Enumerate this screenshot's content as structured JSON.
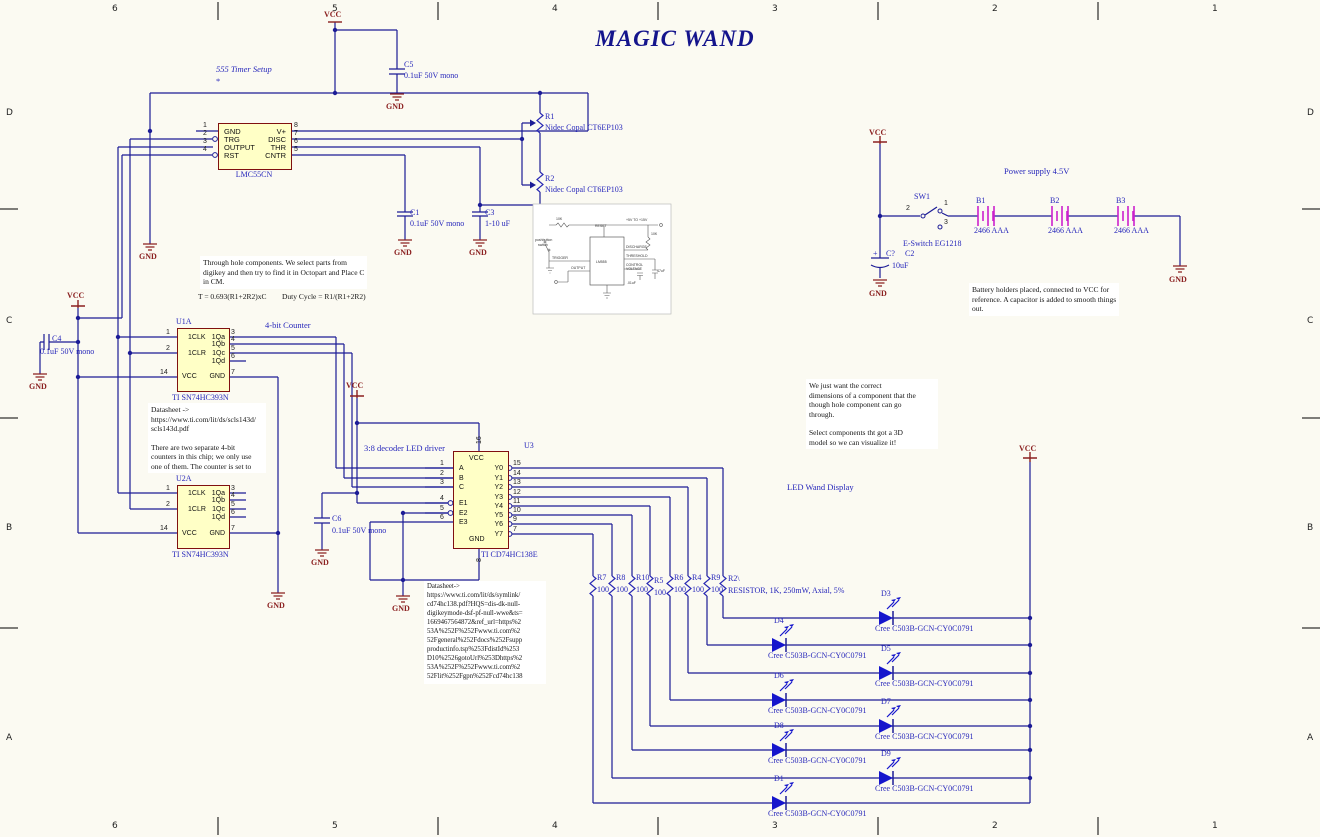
{
  "title": "MAGIC WAND",
  "border": {
    "cols": [
      "6",
      "5",
      "4",
      "3",
      "2",
      "1"
    ],
    "rows": [
      "D",
      "C",
      "B",
      "A"
    ]
  },
  "power": {
    "vcc": "VCC",
    "gnd": "GND"
  },
  "notes": {
    "timer": "555 Timer Setup",
    "star": "*",
    "through": [
      "Through hole components. We select parts from",
      "digikey and then try to find it in Octopart and Place C",
      "in CM."
    ],
    "formula1": "T = 0.693(R1+2R2)xC",
    "formula2": "Duty Cycle = R1/(R1+2R2)",
    "counter": "4-bit Counter",
    "ds393": [
      "Datasheet ->",
      "https://www.ti.com/lit/ds/scls143d/",
      "scls143d.pdf",
      "",
      "There are two separate 4-bit",
      "counters in this chip; we only use",
      "one of them. The counter is set to"
    ],
    "decoder": "3:8 decoder LED driver",
    "ds138": [
      "Datasheet->",
      "https://www.ti.com/lit/ds/symlink/",
      "cd74hc138.pdf?HQS=dis-dk-null-",
      "digikeymode-dsf-pf-null-wwe&ts=",
      "1669467564872&ref_url=https%2",
      "53A%252F%252Fwww.ti.com%2",
      "52Fgeneral%252Fdocs%252Fsupp",
      "productinfo.tsp%253FdistId%253",
      "D10%2526gotoUrl%253Dhttps%2",
      "53A%252F%252Fwww.ti.com%2",
      "52Flit%252Fgpn%252Fcd74hc138"
    ],
    "dims": [
      "We just want the correct",
      "dimensions of a component that the",
      "though hole component can go",
      "through.",
      "",
      "Select components tht got a 3D",
      "model so we can visualize it!"
    ],
    "wand": "LED Wand Display",
    "psu": "Power supply 4.5V",
    "battery": [
      "Battery holders placed, connected to VCC for",
      "reference. A capacitor is added to smooth things",
      "out."
    ]
  },
  "u555": {
    "ref": "LMC55CN",
    "lpins": [
      [
        "1",
        "GND"
      ],
      [
        "2",
        "TRG"
      ],
      [
        "3",
        "OUTPUT"
      ],
      [
        "4",
        "RST"
      ]
    ],
    "rpins": [
      [
        "8",
        "V+"
      ],
      [
        "7",
        "DISC"
      ],
      [
        "6",
        "THR"
      ],
      [
        "5",
        "CNTR"
      ]
    ]
  },
  "u1a": {
    "ref": "U1A",
    "part": "TI SN74HC393N",
    "lpins": [
      [
        "1",
        "1CLK"
      ],
      [
        "2",
        "1CLR"
      ],
      [
        "14",
        "VCC"
      ]
    ],
    "rpins": [
      [
        "3",
        "1Qa"
      ],
      [
        "4",
        "1Qb"
      ],
      [
        "5",
        "1Qc"
      ],
      [
        "6",
        "1Qd"
      ],
      [
        "7",
        "GND"
      ]
    ]
  },
  "u2a": {
    "ref": "U2A",
    "part": "TI SN74HC393N",
    "lpins": [
      [
        "1",
        "1CLK"
      ],
      [
        "2",
        "1CLR"
      ],
      [
        "14",
        "VCC"
      ]
    ],
    "rpins": [
      [
        "3",
        "1Qa"
      ],
      [
        "4",
        "1Qb"
      ],
      [
        "5",
        "1Qc"
      ],
      [
        "6",
        "1Qd"
      ],
      [
        "7",
        "GND"
      ]
    ]
  },
  "u3": {
    "ref": "U3",
    "part": "TI CD74HC138E",
    "top": [
      "16",
      "VCC"
    ],
    "bottom": [
      "8",
      "GND"
    ],
    "lpins": [
      [
        "1",
        "A"
      ],
      [
        "2",
        "B"
      ],
      [
        "3",
        "C"
      ],
      [
        "4",
        "E1"
      ],
      [
        "5",
        "E2"
      ],
      [
        "6",
        "E3"
      ]
    ],
    "rpins": [
      [
        "15",
        "Y0"
      ],
      [
        "14",
        "Y1"
      ],
      [
        "13",
        "Y2"
      ],
      [
        "12",
        "Y3"
      ],
      [
        "11",
        "Y4"
      ],
      [
        "10",
        "Y5"
      ],
      [
        "9",
        "Y6"
      ],
      [
        "7",
        "Y7"
      ]
    ]
  },
  "caps": [
    {
      "ref": "C5",
      "val": "0.1uF 50V mono"
    },
    {
      "ref": "C1",
      "val": "0.1uF 50V mono"
    },
    {
      "ref": "C3",
      "val": "1-10 uF"
    },
    {
      "ref": "C4",
      "val": "0.1uF 50V mono"
    },
    {
      "ref": "C6",
      "val": "0.1uF 50V mono"
    },
    {
      "plus": "+",
      "ref": "C?",
      "ref2": "C2",
      "val": "10uF"
    }
  ],
  "pots": [
    {
      "ref": "R1",
      "part": "Nidec Copal CT6EP103"
    },
    {
      "ref": "R2",
      "part": "Nidec Copal CT6EP103"
    }
  ],
  "res": [
    {
      "ref": "R7",
      "val": "100"
    },
    {
      "ref": "R8",
      "val": "100"
    },
    {
      "ref": "R10",
      "val": "100"
    },
    {
      "ref": "R5",
      "val": "100"
    },
    {
      "ref": "R6",
      "val": "100"
    },
    {
      "ref": "R4",
      "val": "100"
    },
    {
      "ref": "R9",
      "val": "100"
    },
    {
      "ref": "R2\\",
      "val": "RESISTOR, 1K, 250mW, Axial, 5%"
    }
  ],
  "leds": [
    {
      "ref": "D3",
      "part": "Cree C503B-GCN-CY0C0791"
    },
    {
      "ref": "D4",
      "part": "Cree C503B-GCN-CY0C0791"
    },
    {
      "ref": "D5",
      "part": "Cree C503B-GCN-CY0C0791"
    },
    {
      "ref": "D6",
      "part": "Cree C503B-GCN-CY0C0791"
    },
    {
      "ref": "D7",
      "part": "Cree C503B-GCN-CY0C0791"
    },
    {
      "ref": "D8",
      "part": "Cree C503B-GCN-CY0C0791"
    },
    {
      "ref": "D9",
      "part": "Cree C503B-GCN-CY0C0791"
    },
    {
      "ref": "D1",
      "part": "Cree C503B-GCN-CY0C0791"
    }
  ],
  "bats": [
    {
      "ref": "B1",
      "val": "2466 AAA"
    },
    {
      "ref": "B2",
      "val": "2466 AAA"
    },
    {
      "ref": "B3",
      "val": "2466 AAA"
    }
  ],
  "sw": {
    "ref": "SW1",
    "part": "E-Switch EG1218",
    "p1": "1",
    "p2": "2",
    "p3": "3"
  },
  "inset": {
    "labels": [
      "RESET",
      "TRIGGER",
      "OUTPUT",
      "DISCHARGE",
      "THRESHOLD",
      "CONTROL",
      "VOLTAGE",
      "+5V TO +15V",
      "10K",
      "10K",
      "47uF",
      ".01uF",
      "pushbutton",
      "switch",
      "LM555"
    ]
  }
}
